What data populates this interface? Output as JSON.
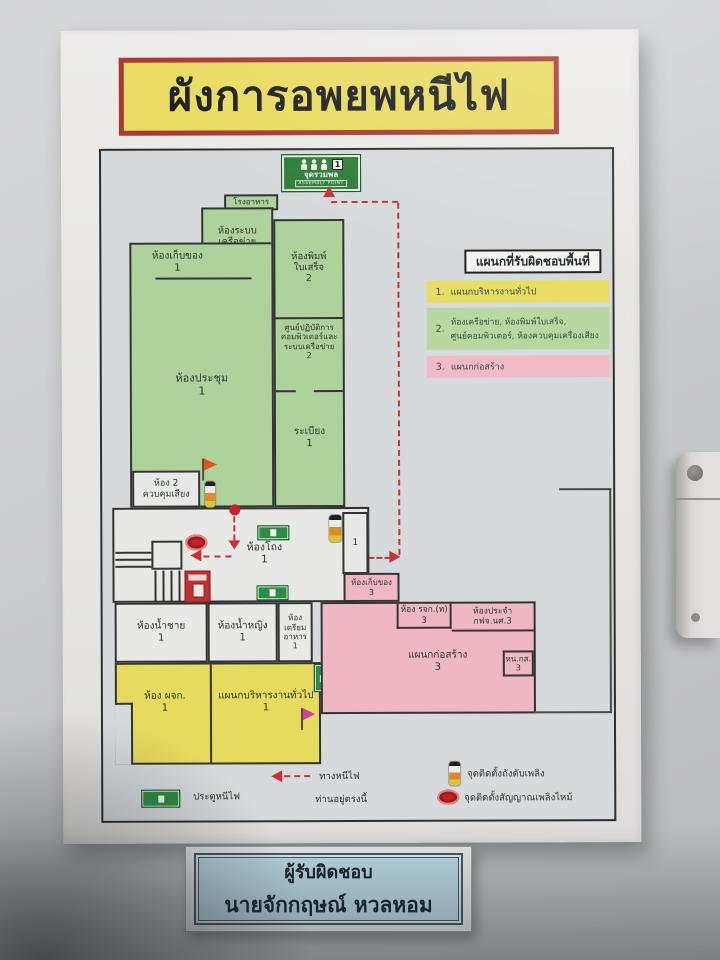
{
  "title_banner": {
    "text": "ผังการอพยพหนีไฟ",
    "bg_color": "#e9db63",
    "border_color": "#a93a35"
  },
  "assembly_sign": {
    "thai": "จุดรวมพล",
    "english": "ASSEMBLY POINT",
    "number": "1"
  },
  "cafeteria_label": "โรงอาหาร",
  "rooms": {
    "storage1": {
      "label": "ห้องเก็บของ\n1"
    },
    "network": {
      "label": "ห้องระบบ\nเครือข่าย\n2"
    },
    "receipt": {
      "label": "ห้องพิมพ์\nใบเสร็จ\n2"
    },
    "computer": {
      "label": "ศูนย์ปฏิบัติการ\nคอมพิวเตอร์และ\nระบบเครือข่าย\n2"
    },
    "meeting": {
      "label": "ห้องประชุม\n1"
    },
    "balcony": {
      "label": "ระเบียง\n1"
    },
    "sound": {
      "label": "ห้อง  2\nควบคุมเสียง"
    },
    "hall": {
      "label": "ห้องโถง\n1"
    },
    "small1": {
      "label": "1"
    },
    "storage3": {
      "label": "ห้องเก็บของ\n3"
    },
    "rjk": {
      "label": "ห้อง รจก.(ท)\n3"
    },
    "prajam": {
      "label": "ห้องประจำ\nกฟจ.นศ.3"
    },
    "construction": {
      "label": "แผนกก่อสร้าง\n3"
    },
    "hnks": {
      "label": "หน.กส.\n3"
    },
    "toilet_men": {
      "label": "ห้องน้ำชาย\n1"
    },
    "toilet_women": {
      "label": "ห้องน้ำหญิง\n1"
    },
    "food_prep": {
      "label": "ห้อง\nเตรียม\nอาหาร\n1"
    },
    "manager": {
      "label": "ห้อง ผจก.\n1"
    },
    "admin": {
      "label": "แผนกบริหารงานทั่วไป\n1"
    }
  },
  "legend_panel": {
    "header": "แผนกที่รับผิดชอบพื้นที่",
    "items": [
      {
        "num": "1.",
        "label": "แผนกบริหารงานทั่วไป",
        "color": "#e8dd64"
      },
      {
        "num": "2.",
        "label": "ห้องเครือข่าย, ห้องพิมพ์ใบเสร็จ,\nศูนย์คอมพิวเตอร์, ห้องควบคุมเครื่องเสียง",
        "color": "#b7d9a1"
      },
      {
        "num": "3.",
        "label": "แผนกก่อสร้าง",
        "color": "#f2b9c6"
      }
    ]
  },
  "map_legend": {
    "exit_door": "ประตูหนีไฟ",
    "escape_route": "ทางหนีไฟ",
    "you_are_here": "ท่านอยู่ตรงนี้",
    "extinguisher": "จุดติดตั้งถังดับเพลิง",
    "fire_alarm": "จุดติดตั้งสัญญาณเพลิงไหม้"
  },
  "responsible_sign": {
    "title": "ผู้รับผิดชอบ",
    "name": "นายจักกฤษณ์ หวลหอม"
  },
  "colors": {
    "zone_green": "#aed29b",
    "zone_yellow": "#e6da5f",
    "zone_pink": "#efb7c3",
    "route_red": "#c53434"
  }
}
